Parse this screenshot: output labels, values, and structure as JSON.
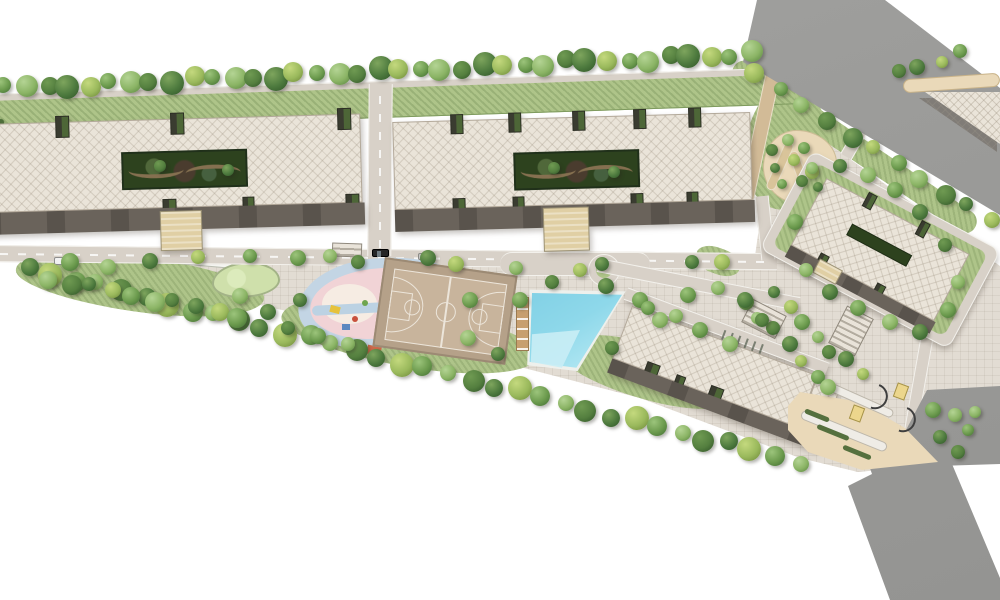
{
  "meta": {
    "title": "Residential complex master plan — aerial site rendering",
    "type": "architectural site plan",
    "text_visible": "none"
  },
  "palette": {
    "canvas": "#ffffff",
    "lawn": "#aec489",
    "tree_dark": "#4d7a3e",
    "tree_mid": "#6b9a4d",
    "tree_light": "#8bb465",
    "tree_olive": "#9ab95c",
    "road": "#d8d1c8",
    "road_edge": "#f3f1ec",
    "building_fill": "#eae4d9",
    "building_edge": "#b3a99a",
    "building_shadow": "#6a635b",
    "courtyard_green": "#2d421e",
    "canopy_tan": "#e0cfa4",
    "plaza": "#e2dcd3",
    "pool_water": "#84d0e5",
    "pool_shallow": "#c9edf5",
    "pool_deck": "#c79f6f",
    "court_apron": "#b5a189",
    "court_floor": "#c8b49c",
    "court_line": "#ece5da",
    "play_ring": "#c3d5e4",
    "play_pink": "#f1d3d6",
    "play_cream": "#f6ece3",
    "play_splash": "#d9c49a",
    "pond_fill": "#cfe0ab",
    "pond_edge": "#a3b387",
    "sand": "#ead9b9",
    "highway": "#9b9b99",
    "kiosk": "#ecd68c"
  },
  "features": {
    "site": "Residential complex aerial master plan",
    "boulevard_trees": "Tree-lined boulevard",
    "boulevard_road": "Perimeter boulevard road",
    "boulevard_lawn": "Boulevard lawn strip",
    "building_a": "Residential slab building A with courtyard",
    "courtyard_a": "Building A landscaped courtyard",
    "canopy_a": "Building A entrance canopy",
    "building_b": "Residential slab building B with courtyard",
    "courtyard_b": "Building B landscaped courtyard",
    "canopy_b": "Building B entrance canopy",
    "building_c": "Rotated residential building C with lawn ring",
    "building_d": "Residential building D",
    "pergola": "Pergola walkway",
    "internal_road": "Internal spine road",
    "connector_road": "Access road between buildings A and B",
    "garden": "Sand garden with shrubs",
    "pond": "Landscaped pond",
    "stream": "Water feature",
    "playground": "Children's playground",
    "basketball": "Basketball court",
    "pool": "Swimming pool",
    "pool_deck": "Sun deck with loungers",
    "plaza": "Paved amenity plaza",
    "highway": "Highway corridor",
    "service_spur": "Service road spur",
    "service_trunk": "Exit road",
    "triangle_block": "Corner triangle block",
    "access_strip": "Tan access strip",
    "stairs": "Plaza steps and ramps",
    "kiosks": "Entrance kiosk",
    "gates": "Entrance gate arc",
    "hedges": "Clipped hedge",
    "paths": "Pedestrian path",
    "roundabout": "Planting circle in road",
    "car_dark": "Parked car (dark)",
    "car_white": "Parked car (white)",
    "car_gray": "Parked car (gray)",
    "tree": "Tree"
  }
}
